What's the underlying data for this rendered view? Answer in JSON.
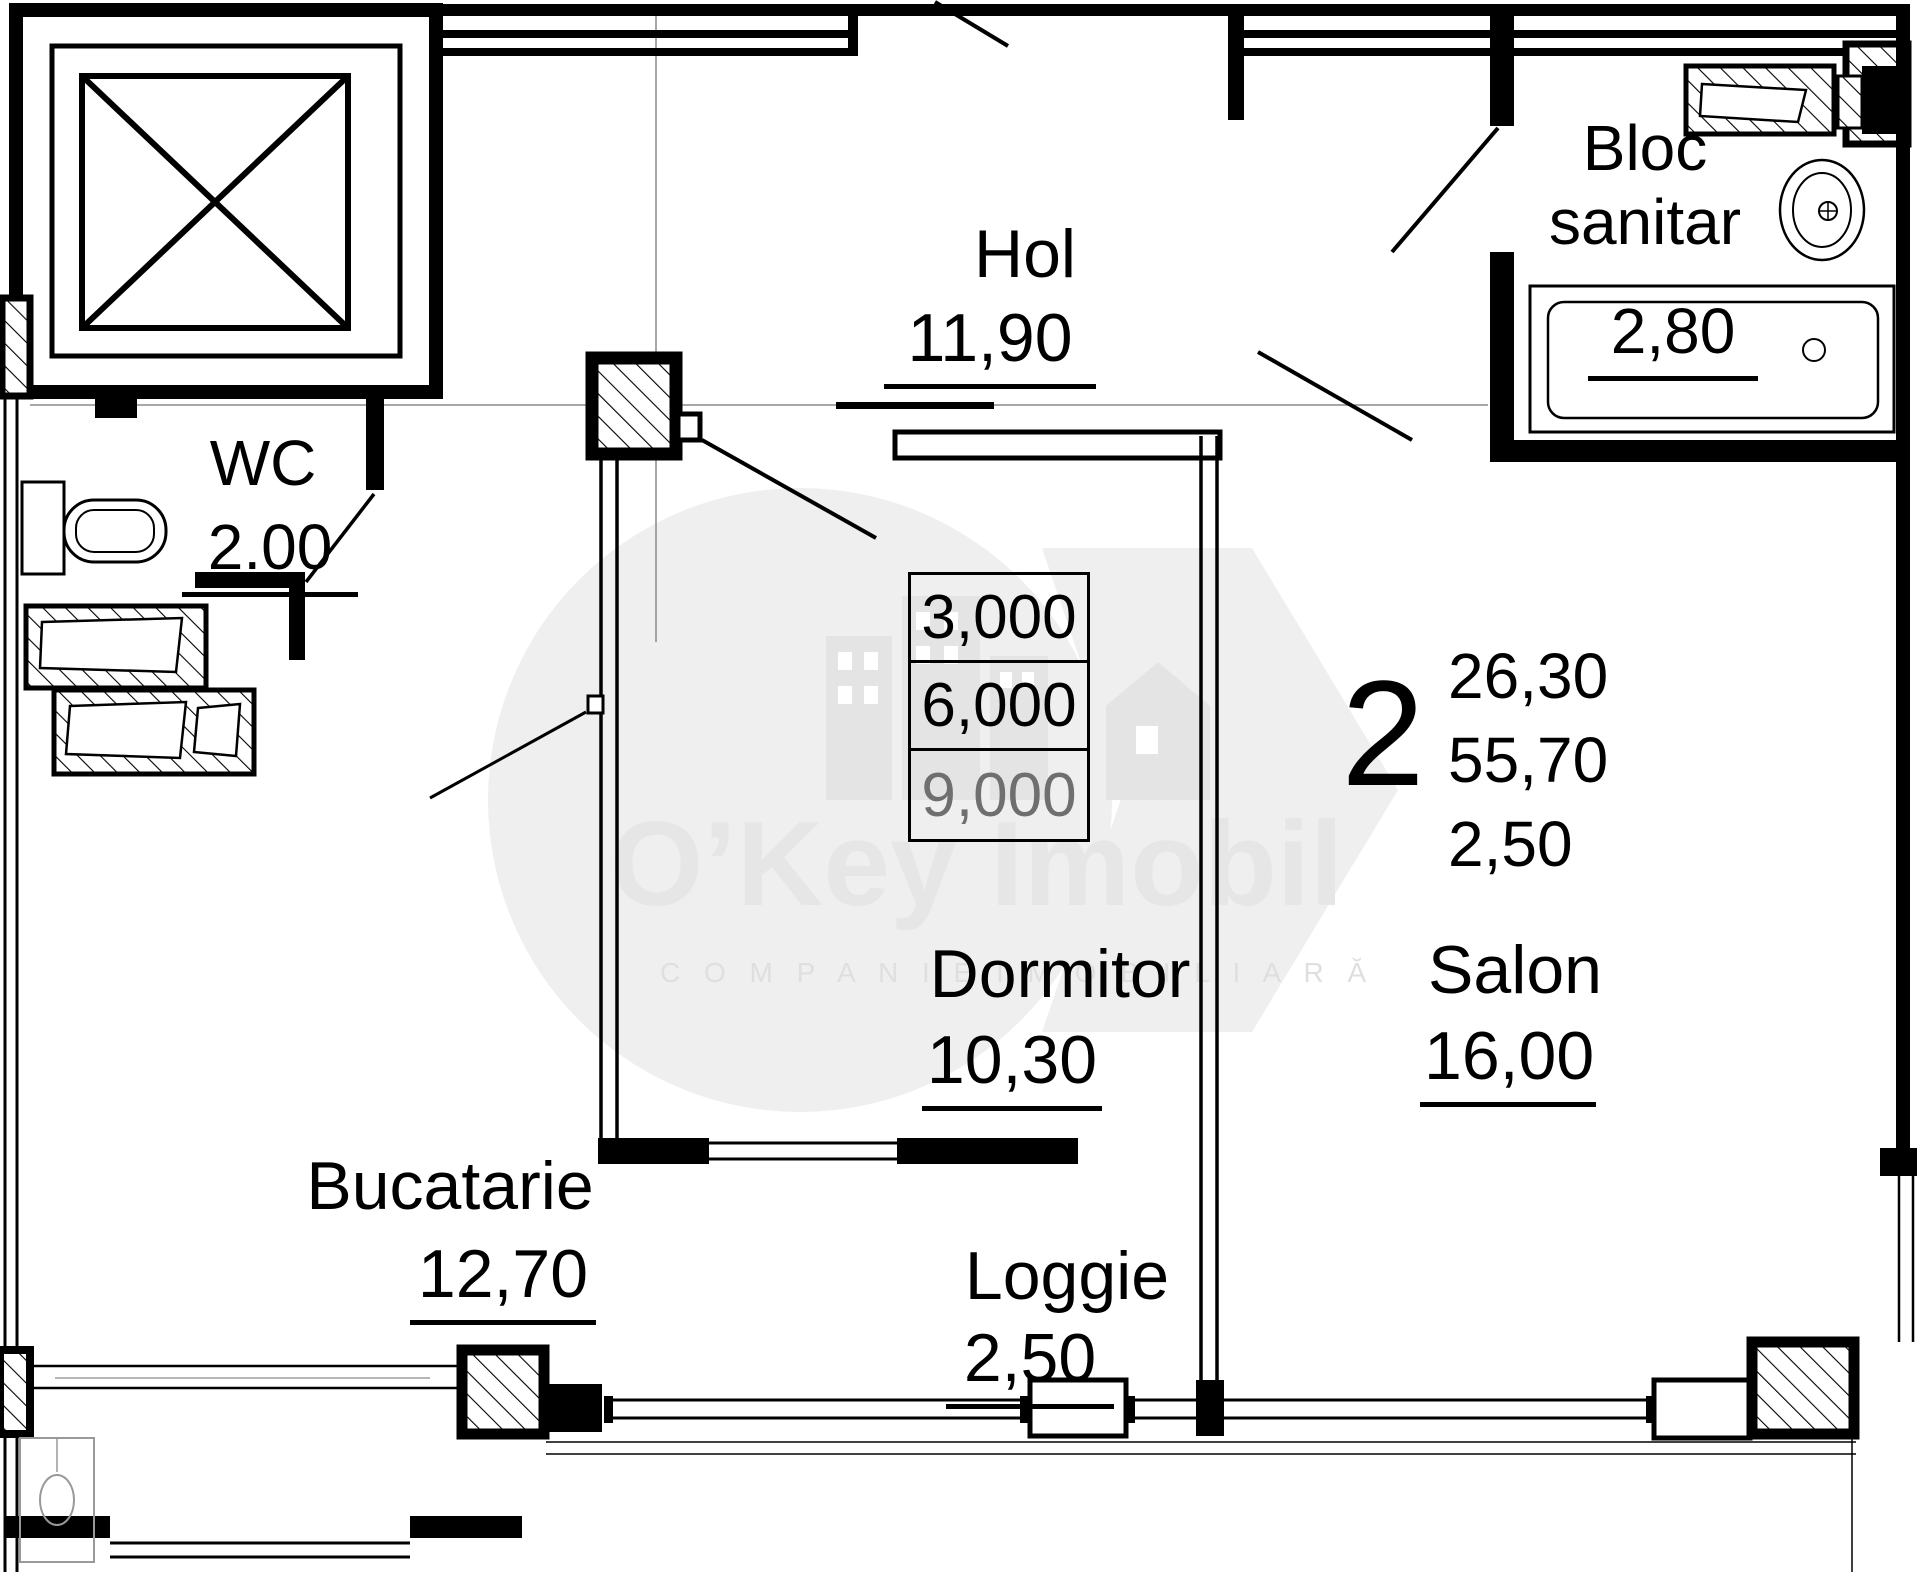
{
  "plan": {
    "rooms": [
      {
        "id": "hol",
        "name": "Hol",
        "area": "11,90"
      },
      {
        "id": "wc",
        "name": "WC",
        "area": "2.00"
      },
      {
        "id": "bloc_sanitar",
        "name": "Bloc sanitar",
        "area": "2,80"
      },
      {
        "id": "dormitor",
        "name": "Dormitor",
        "area": "10,30"
      },
      {
        "id": "salon",
        "name": "Salon",
        "area": "16,00"
      },
      {
        "id": "bucatarie",
        "name": "Bucatarie",
        "area": "12,70"
      },
      {
        "id": "loggie",
        "name": "Loggie",
        "area": "2,50"
      }
    ],
    "dimension_table": {
      "rows": [
        "3,000",
        "6,000",
        "9,000"
      ]
    },
    "apartment_summary": {
      "rooms_count": "2",
      "living_area": "26,30",
      "total_area": "55,70",
      "loggia_area": "2,50"
    },
    "watermark": {
      "brand": "O’Key Imobil",
      "tagline": "C O M P A N I E   I M O B I L I A R Ă"
    },
    "colors": {
      "line": "#000000",
      "watermark": "#ececec",
      "faint_line": "#8a8a8a"
    }
  }
}
